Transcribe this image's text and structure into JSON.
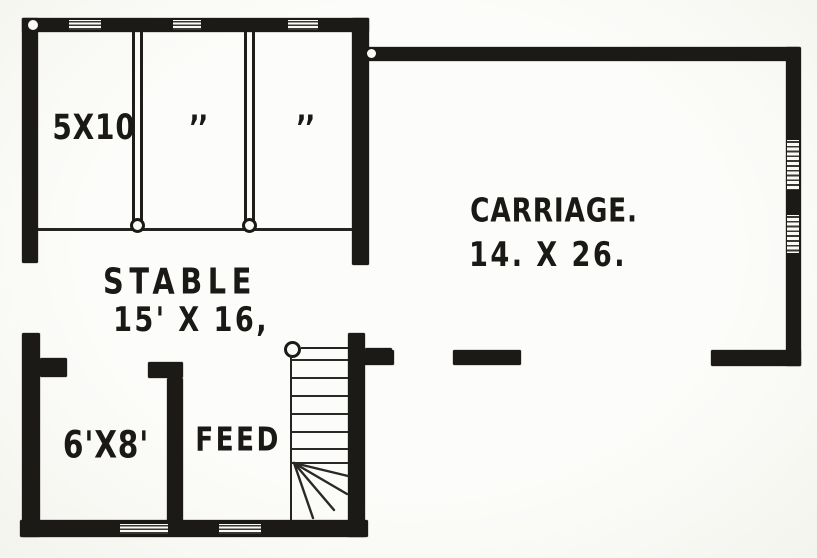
{
  "plan": {
    "stalls": {
      "stall1_label": "5X10",
      "stall2_label": "’’",
      "stall3_label": "’’"
    },
    "stable": {
      "name": "STABLE",
      "size": "15' X 16,"
    },
    "carriage": {
      "name": "CARRIAGE.",
      "size": "14. X 26."
    },
    "storeroom": {
      "size": "6'X8'"
    },
    "feed_room": {
      "name": "FEED"
    },
    "colors": {
      "ink": "#1c1a17",
      "paper": "#fafaf7"
    }
  }
}
